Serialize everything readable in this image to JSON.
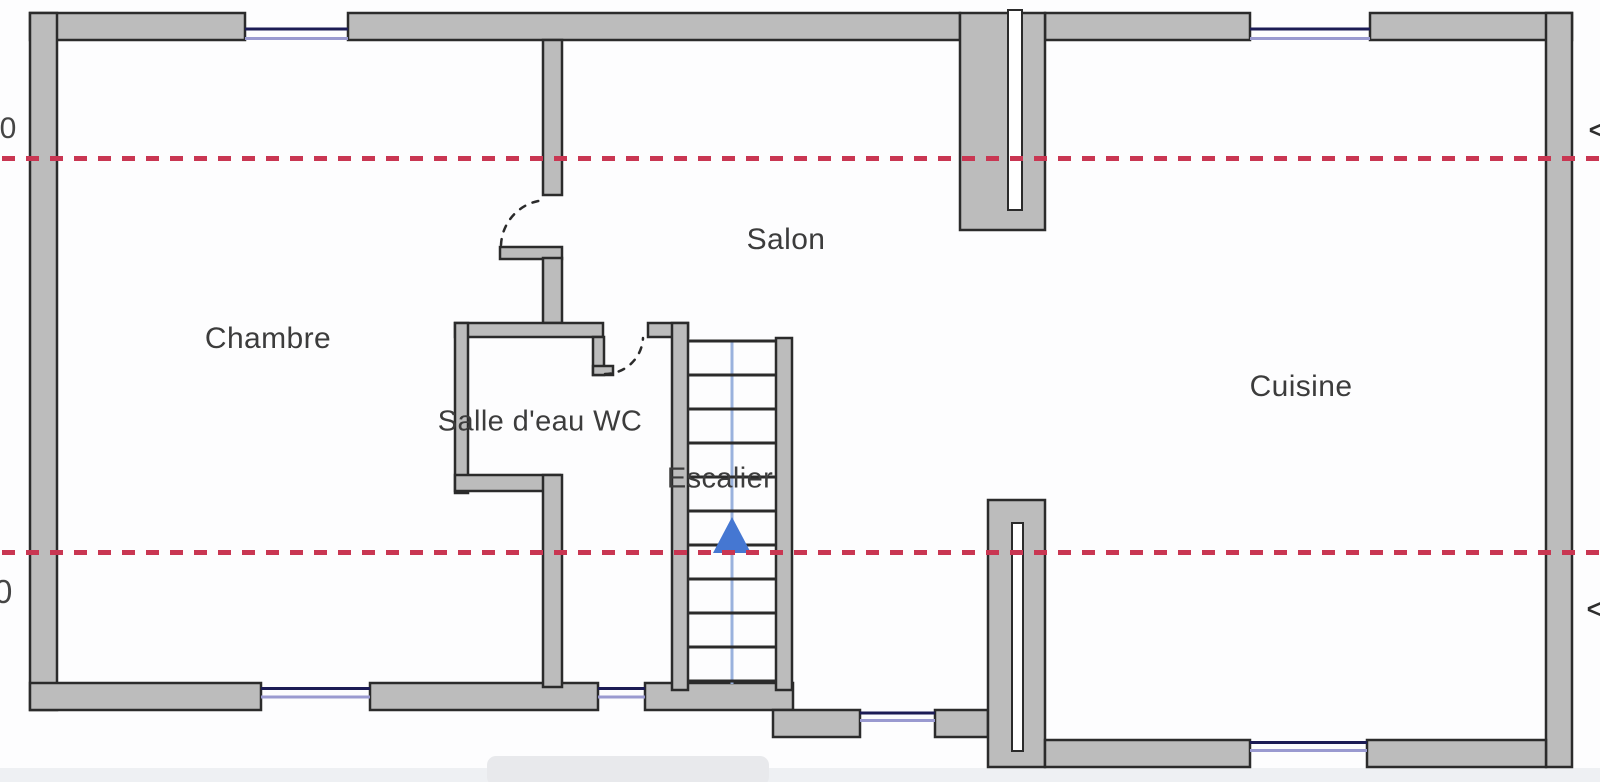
{
  "rooms": {
    "chambre": {
      "label": "Chambre"
    },
    "salon": {
      "label": "Salon"
    },
    "salle_eau": {
      "label": "Salle d'eau WC"
    },
    "escalier": {
      "label": "Escalier"
    },
    "cuisine": {
      "label": "Cuisine"
    }
  },
  "section_markers": {
    "left_top": "30",
    "left_bottom": "0",
    "right_top": "<",
    "right_bottom": "<"
  },
  "stairs": {
    "tread_count": 11,
    "direction": "up"
  },
  "colors": {
    "wall": "#bcbcbc",
    "line": "#2b2b2b",
    "window_dark": "#1c1c55",
    "window_light": "#9a9ad0",
    "section_red": "#c93652",
    "stair_arrow": "#4577d2",
    "stair_line": "#9ab2dd",
    "text": "#3c3c3c"
  }
}
